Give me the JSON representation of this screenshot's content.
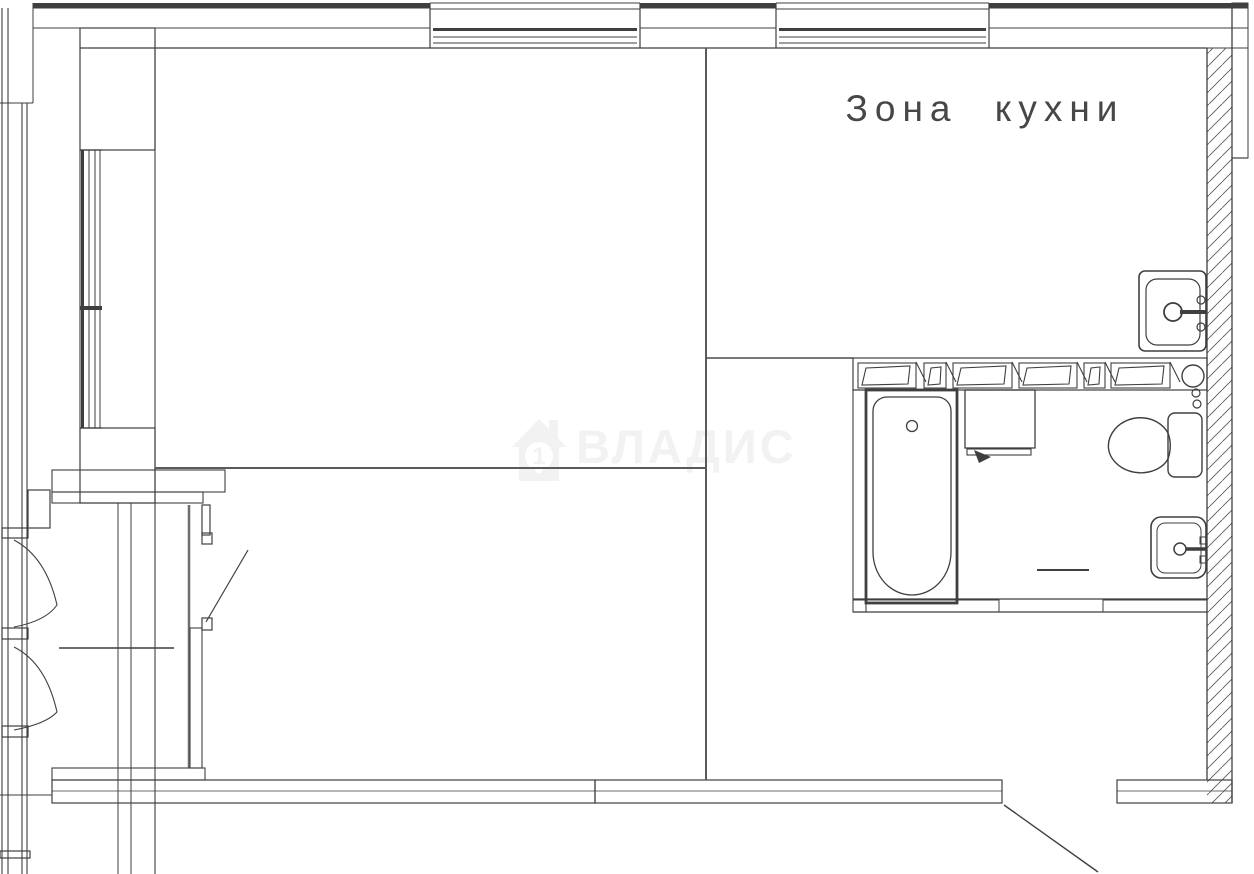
{
  "labels": {
    "kitchen_zone": "Зона кухни"
  },
  "watermark": {
    "brand": "ВЛАДИС",
    "icon": "house-icon",
    "number": "1"
  },
  "colors": {
    "line": "#3f3f3f",
    "line_light": "#6e6e6e",
    "watermark": "#f2f2f2",
    "background": "#ffffff"
  },
  "fixtures": [
    "bathtub",
    "washing-machine",
    "toilet",
    "bathroom-sink",
    "kitchen-sink",
    "closet-shelf",
    "entrance-door-swing",
    "balcony-door-leaves",
    "window-top-left",
    "window-top-right",
    "window-left"
  ]
}
